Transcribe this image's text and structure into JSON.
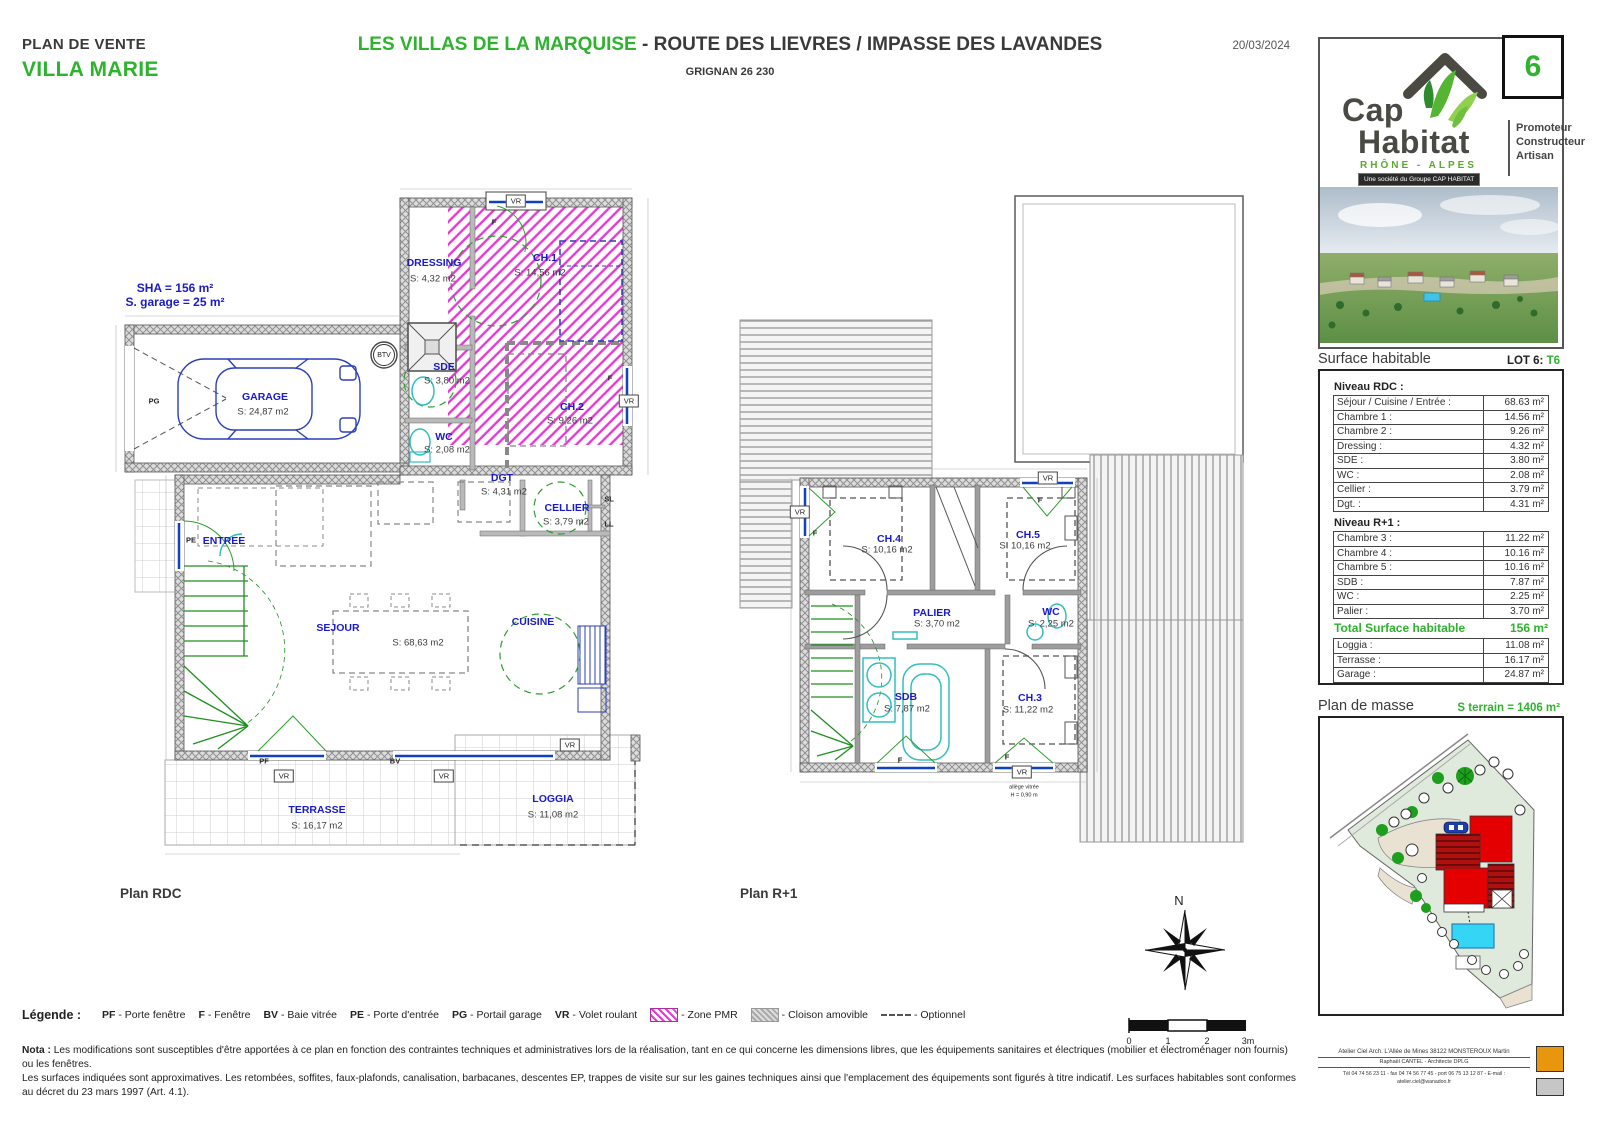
{
  "header": {
    "doc_type": "PLAN DE VENTE",
    "villa_name": "VILLA MARIE",
    "project_title": "LES VILLAS DE LA MARQUISE",
    "project_subtitle": " - ROUTE DES LIEVRES / IMPASSE DES LAVANDES",
    "city": "GRIGNAN 26 230",
    "date": "20/03/2024",
    "lot_number": "6"
  },
  "logo": {
    "brand_line1": "Cap",
    "brand_line2": "Habitat",
    "region": "RHÔNE - ALPES",
    "group": "Une société du Groupe CAP HABITAT",
    "tagline1": "Promoteur",
    "tagline2": "Constructeur",
    "tagline3": "Artisan"
  },
  "tags": {
    "vr": "VR",
    "f": "F",
    "pf": "PF",
    "bv": "BV",
    "pe": "PE",
    "pg": "PG",
    "sl": "SL",
    "ll": "LL",
    "btv": "BTV"
  },
  "plans": {
    "rdc": {
      "label": "Plan RDC",
      "sha_note_1": "SHA = 156 m²",
      "sha_note_2": "S. garage = 25 m²",
      "rooms": [
        {
          "name": "GARAGE",
          "area": "S: 24,87 m2"
        },
        {
          "name": "DRESSING",
          "area": "S: 4,32 m2"
        },
        {
          "name": "CH.1",
          "area": "S: 14,56 m2"
        },
        {
          "name": "SDE",
          "area": "S: 3,80 m2"
        },
        {
          "name": "WC",
          "area": "S: 2,08 m2"
        },
        {
          "name": "CH.2",
          "area": "S: 9,26 m2"
        },
        {
          "name": "DGT",
          "area": "S: 4,31 m2"
        },
        {
          "name": "CELLIER",
          "area": "S: 3,79 m2"
        },
        {
          "name": "ENTREE",
          "area": ""
        },
        {
          "name": "SEJOUR",
          "area": "S: 68,63 m2"
        },
        {
          "name": "CUISINE",
          "area": ""
        },
        {
          "name": "TERRASSE",
          "area": "S: 16,17 m2"
        },
        {
          "name": "LOGGIA",
          "area": "S: 11,08 m2"
        }
      ]
    },
    "r1": {
      "label": "Plan R+1",
      "rooms": [
        {
          "name": "CH.4",
          "area": "S: 10,16 m2"
        },
        {
          "name": "CH.5",
          "area": "S: 10,16 m2"
        },
        {
          "name": "PALIER",
          "area": "S: 3,70 m2"
        },
        {
          "name": "WC",
          "area": "S: 2,25 m2"
        },
        {
          "name": "SDB",
          "area": "S: 7,87 m2"
        },
        {
          "name": "CH.3",
          "area": "S: 11,22 m2"
        }
      ],
      "window_note_1": "allège vitrée",
      "window_note_2": "H = 0,90 m"
    }
  },
  "surface_table": {
    "title": "Surface habitable",
    "lot_label": "LOT 6:",
    "lot_type": "T6",
    "rdc_header": "Niveau RDC :",
    "rdc_rows": [
      {
        "label": "Séjour / Cuisine / Entrée :",
        "value": "68.63 m²"
      },
      {
        "label": "Chambre 1 :",
        "value": "14.56 m²"
      },
      {
        "label": "Chambre 2 :",
        "value": "9.26 m²"
      },
      {
        "label": "Dressing :",
        "value": "4.32 m²"
      },
      {
        "label": "SDE :",
        "value": "3.80 m²"
      },
      {
        "label": "WC :",
        "value": "2.08 m²"
      },
      {
        "label": "Cellier   :",
        "value": "3.79 m²"
      },
      {
        "label": "Dgt. :",
        "value": "4.31 m²"
      }
    ],
    "r1_header": "Niveau R+1 :",
    "r1_rows": [
      {
        "label": "Chambre 3 :",
        "value": "11.22 m²"
      },
      {
        "label": "Chambre 4 :",
        "value": "10.16 m²"
      },
      {
        "label": "Chambre 5 :",
        "value": "10.16 m²"
      },
      {
        "label": "SDB :",
        "value": "7.87 m²"
      },
      {
        "label": "WC :",
        "value": "2.25 m²"
      },
      {
        "label": "Palier :",
        "value": "3.70 m²"
      }
    ],
    "total_label": "Total Surface habitable",
    "total_value": "156 m²",
    "annex_rows": [
      {
        "label": "Loggia :",
        "value": "11.08 m²"
      },
      {
        "label": "Terrasse :",
        "value": "16.17 m²"
      },
      {
        "label": "Garage :",
        "value": "24.87 m²"
      }
    ]
  },
  "site_plan": {
    "title": "Plan de masse",
    "terrain_area": "S terrain = 1406 m²"
  },
  "compass": {
    "north_label": "N"
  },
  "scale_bar": {
    "ticks": [
      "0",
      "1",
      "2",
      "3m"
    ]
  },
  "legend": {
    "title": "Légende :",
    "items": [
      {
        "abbr": "PF",
        "label": "- Porte fenêtre"
      },
      {
        "abbr": "F",
        "label": "- Fenêtre"
      },
      {
        "abbr": "BV",
        "label": "- Baie vitrée"
      },
      {
        "abbr": "PE",
        "label": "- Porte d'entrée"
      },
      {
        "abbr": "PG",
        "label": "- Portail garage"
      },
      {
        "abbr": "VR",
        "label": "- Volet roulant"
      }
    ],
    "swatch_items": [
      {
        "label": "- Zone PMR"
      },
      {
        "label": "- Cloison amovible"
      },
      {
        "label": "- Optionnel"
      }
    ]
  },
  "nota": {
    "label": "Nota :",
    "line1": "Les modifications sont susceptibles d'être apportées à ce plan en fonction des contraintes techniques et administratives lors de la réalisation, tant en ce qui concerne les dimensions libres, que les équipements sanitaires et électriques (mobilier et électroménager non fournis) ou les fenêtres.",
    "line2": "Les surfaces indiquées sont approximatives. Les retombées, soffites, faux-plafonds, canalisation, barbacanes, descentes EP, trappes de visite sur sur les gaines techniques ainsi que l'emplacement des équipements sont figurés à titre indicatif. Les surfaces habitables sont conformes au décret du 23 mars 1997 (Art. 4.1)."
  },
  "architect": {
    "line1": "Atelier Ciel Arch.  L'Allée de Mines  38122  MONSTEROUX Martin",
    "line2": "Raphaël CANTEL - Architecte DPLG",
    "line3": "Tél 04 74 56 23 11 - fax 04 74 56 77 45 - port 06 75 13 12 87 - E-mail : atelier.ciel@wanadoo.fr"
  }
}
